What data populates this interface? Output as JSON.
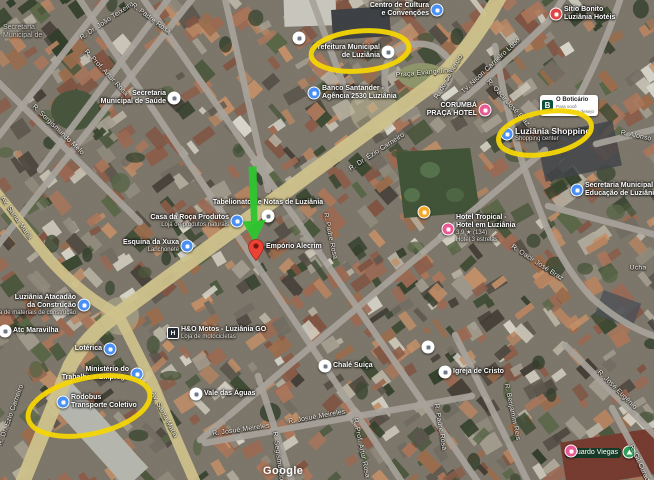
{
  "map": {
    "attribution": "Google",
    "colors": {
      "road_main": "#cfc28b",
      "road_minor": "#a6a29a",
      "annotation_yellow": "#f4d505",
      "arrow_green": "#2fc42f",
      "pin_red": "#ea4335",
      "poi_blue": "#4a90f4",
      "poi_pink": "#e85a93",
      "poi_red": "#e04545",
      "poi_orange": "#f5a623",
      "poi_green": "#2e9e5b",
      "poi_white": "#ffffff"
    },
    "pois": [
      {
        "id": "corner-label",
        "type": "none",
        "x": 3,
        "y": 24,
        "side": "corner",
        "muted": true,
        "lines": [
          "Secretaria",
          "Municipal de"
        ],
        "subs": []
      },
      {
        "id": "secretaria-saude",
        "type": "white",
        "x": 174,
        "y": 98,
        "side": "left",
        "lines": [
          "Secretaria",
          "Municipal de Saúde"
        ],
        "subs": []
      },
      {
        "id": "prefeitura-municipal",
        "type": "white",
        "x": 388,
        "y": 52,
        "side": "left",
        "lines": [
          "Prefeitura Municipal",
          "de Luziânia"
        ],
        "subs": []
      },
      {
        "id": "banco-santander",
        "type": "blue",
        "x": 314,
        "y": 93,
        "side": "right",
        "lines": [
          "Banco Santander -",
          "Agência 2530 Luziânia"
        ],
        "subs": []
      },
      {
        "id": "centro-cultura",
        "type": "blue",
        "x": 437,
        "y": 10,
        "side": "left",
        "lines": [
          "Centro de Cultura",
          "e Convenções"
        ],
        "subs": []
      },
      {
        "id": "corumba-praca-hotel",
        "type": "pink",
        "x": 485,
        "y": 110,
        "side": "left",
        "lines": [
          "CORUMBÁ",
          "PRAÇA HOTEL"
        ],
        "subs": []
      },
      {
        "id": "sitio-bonito-hotel",
        "type": "red",
        "x": 556,
        "y": 14,
        "side": "right",
        "lines": [
          "Sítio Bonito",
          "Luziânia Hotéis"
        ],
        "subs": []
      },
      {
        "id": "luziania-shopping",
        "type": "blue",
        "x": 507,
        "y": 134,
        "side": "right",
        "big": true,
        "lines": [
          "Luziânia Shopping"
        ],
        "subs": [
          "Shopping center"
        ]
      },
      {
        "id": "secretaria-educacao",
        "type": "blue",
        "x": 577,
        "y": 190,
        "side": "right",
        "lines": [
          "Secretaria Municipal de",
          "Educação de Luziânia"
        ],
        "subs": []
      },
      {
        "id": "hotel-tropical",
        "type": "pink",
        "x": 448,
        "y": 229,
        "side": "right",
        "lines": [
          "Hotel Tropical -",
          "Hotel em Luziânia"
        ],
        "subs": [
          "3,9 ★ (134)",
          "Hotel 3 estrelas"
        ]
      },
      {
        "id": "restaurant-dot",
        "type": "orange",
        "x": 424,
        "y": 212,
        "side": "none",
        "lines": [],
        "subs": []
      },
      {
        "id": "tabelionato",
        "type": "white",
        "x": 268,
        "y": 216,
        "side": "above",
        "lines": [
          "Tabelionato de Notas de Luziânia"
        ],
        "subs": []
      },
      {
        "id": "casa-da-roca",
        "type": "blue",
        "x": 237,
        "y": 221,
        "side": "left",
        "lines": [
          "Casa da Roça Produtos"
        ],
        "subs": [
          "Loja de produtos naturais"
        ]
      },
      {
        "id": "esquina-da-xuxa",
        "type": "blue",
        "x": 187,
        "y": 246,
        "side": "left",
        "lines": [
          "Esquina da Xuxa"
        ],
        "subs": [
          "Lanchonete"
        ]
      },
      {
        "id": "ministerio-trabalho",
        "type": "blue",
        "x": 137,
        "y": 374,
        "side": "left",
        "lines": [
          "Ministério do",
          "Trabalho e Emprego"
        ],
        "subs": []
      },
      {
        "id": "atacadao-construcao",
        "type": "blue",
        "x": 84,
        "y": 305,
        "side": "left",
        "lines": [
          "Luziânia Atacadão",
          "da Construção"
        ],
        "subs": [
          "Loja de materiais de construção"
        ]
      },
      {
        "id": "atc-maravilha",
        "type": "white",
        "x": 5,
        "y": 331,
        "side": "right",
        "lines": [
          "Atc Maravilha"
        ],
        "subs": []
      },
      {
        "id": "ho-motos",
        "type": "sq",
        "x": 173,
        "y": 333,
        "side": "right",
        "lines": [
          "H&O Motos - Luziânia GO"
        ],
        "subs": [
          "Loja de motocicletas"
        ]
      },
      {
        "id": "loterica",
        "type": "blue",
        "x": 110,
        "y": 349,
        "side": "left",
        "lines": [
          "Lotérica"
        ],
        "subs": []
      },
      {
        "id": "rodobus-terminal",
        "type": "blue",
        "x": 63,
        "y": 402,
        "side": "right",
        "lines": [
          "Rodobus",
          "Transporte Coletivo"
        ],
        "subs": []
      },
      {
        "id": "vale-das-aguas",
        "type": "white",
        "x": 196,
        "y": 394,
        "side": "right",
        "lines": [
          "Vale das Águas"
        ],
        "subs": []
      },
      {
        "id": "chale-suica",
        "type": "white",
        "x": 325,
        "y": 366,
        "side": "right",
        "lines": [
          "Chalé Suíça"
        ],
        "subs": []
      },
      {
        "id": "igreja-de-cristo",
        "type": "white",
        "x": 445,
        "y": 372,
        "side": "right",
        "lines": [
          "Igreja de Cristo"
        ],
        "subs": []
      },
      {
        "id": "poi-dot-1",
        "type": "white",
        "x": 428,
        "y": 347,
        "side": "none",
        "lines": [],
        "subs": []
      },
      {
        "id": "poi-dot-2",
        "type": "white",
        "x": 299,
        "y": 38,
        "side": "none",
        "lines": [],
        "subs": []
      },
      {
        "id": "eduardo-viegas",
        "type": "green",
        "x": 629,
        "y": 452,
        "side": "left",
        "pill": "dark",
        "lines": [
          "Eduardo Viegas"
        ],
        "subs": []
      },
      {
        "id": "poi-dot-3",
        "type": "pink",
        "x": 571,
        "y": 451,
        "side": "none",
        "lines": [],
        "subs": []
      }
    ],
    "pill_ad": {
      "x": 540,
      "y": 95,
      "icon_letter": "B",
      "title": "O Boticário",
      "sub1": "Para você",
      "sub2": "despertar o desejo"
    },
    "streets": [
      {
        "name": "R. Dr. João Teixeira",
        "x": 107,
        "y": 21,
        "a": -34
      },
      {
        "name": "R. Padre Rosa",
        "x": 151,
        "y": 19,
        "a": 37
      },
      {
        "name": "R. Prof. Artur Rosa",
        "x": 106,
        "y": 73,
        "a": 47
      },
      {
        "name": "R. Sorgismundo Melo",
        "x": 58,
        "y": 130,
        "a": 44
      },
      {
        "name": "Av. Santa Maria",
        "x": 16,
        "y": 218,
        "a": 55
      },
      {
        "name": "R. Dr. Ézio Carneiro",
        "x": 377,
        "y": 152,
        "a": -33
      },
      {
        "name": "R. do Comércio",
        "x": 449,
        "y": 77,
        "a": -60
      },
      {
        "name": "Tv. Nicon Carneiro Lôbo",
        "x": 491,
        "y": 66,
        "a": -43
      },
      {
        "name": "R. Oacir José Braz",
        "x": 508,
        "y": 103,
        "a": 48
      },
      {
        "name": "R. Afonso",
        "x": 636,
        "y": 136,
        "a": 12
      },
      {
        "name": "R. Padre Rosa",
        "x": 330,
        "y": 236,
        "a": 78
      },
      {
        "name": "R. Dr. Ézio Carneiro",
        "x": 11,
        "y": 415,
        "a": -70
      },
      {
        "name": "Av. Santa Maria",
        "x": 164,
        "y": 415,
        "a": 62
      },
      {
        "name": "R. Oacir José Braz",
        "x": 537,
        "y": 263,
        "a": 33
      },
      {
        "name": "R. Josué Meireles",
        "x": 317,
        "y": 417,
        "a": -10
      },
      {
        "name": "R. Josué Meireles",
        "x": 241,
        "y": 430,
        "a": -8
      },
      {
        "name": "R. Prof. Artur Rosa",
        "x": 361,
        "y": 448,
        "a": 78
      },
      {
        "name": "R. Segismundo",
        "x": 278,
        "y": 456,
        "a": 82
      },
      {
        "name": "R. Benjamim Reis",
        "x": 512,
        "y": 412,
        "a": 78
      },
      {
        "name": "R. José Eugênio",
        "x": 617,
        "y": 390,
        "a": 45
      },
      {
        "name": "R. Padre Rosa",
        "x": 440,
        "y": 427,
        "a": 80
      },
      {
        "name": "R. Gil Curado",
        "x": 640,
        "y": 465,
        "a": 65
      },
      {
        "name": "Ucha",
        "x": 638,
        "y": 268,
        "a": 0
      },
      {
        "name": "Praça Evangelina",
        "x": 424,
        "y": 73,
        "a": -5
      }
    ],
    "annotations": {
      "circles": [
        {
          "target": "prefeitura-municipal",
          "cx": 360,
          "cy": 51,
          "rx": 49,
          "ry": 20,
          "rot": -5
        },
        {
          "target": "luziania-shopping",
          "cx": 545,
          "cy": 133,
          "rx": 47,
          "ry": 21,
          "rot": -10
        },
        {
          "target": "rodobus-terminal",
          "cx": 89,
          "cy": 406,
          "rx": 62,
          "ry": 28,
          "rot": -12
        }
      ],
      "arrow": {
        "from_x": 250,
        "from_y": 167,
        "to_x": 254,
        "to_y": 243
      },
      "pin": {
        "label": "Empório Alecrim",
        "x": 256,
        "y": 247
      }
    }
  }
}
